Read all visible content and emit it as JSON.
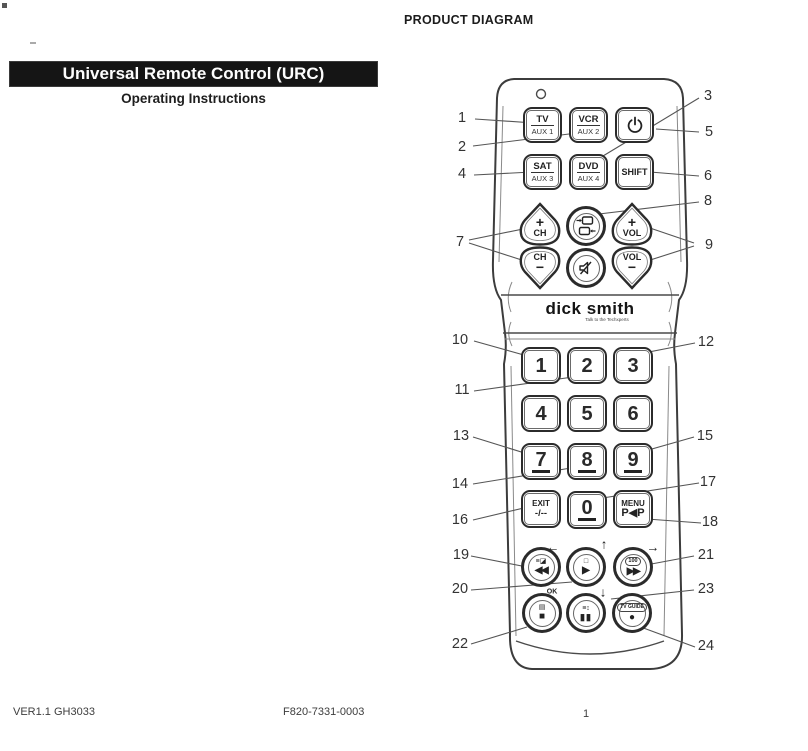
{
  "page": {
    "heading": "PRODUCT DIAGRAM",
    "banner_title": "Universal Remote Control (URC)",
    "subtitle": "Operating Instructions",
    "footer": {
      "version": "VER1.1 GH3033",
      "code": "F820-7331-0003",
      "page_number": "1"
    }
  },
  "remote": {
    "brand": "dick smith",
    "brand_tagline": "Talk to the Techxperts",
    "device_keys": {
      "tv": {
        "top": "TV",
        "bottom": "AUX 1"
      },
      "vcr": {
        "top": "VCR",
        "bottom": "AUX 2"
      },
      "sat": {
        "top": "SAT",
        "bottom": "AUX 3"
      },
      "dvd": {
        "top": "DVD",
        "bottom": "AUX 4"
      }
    },
    "shift_label": "SHIFT",
    "channel": {
      "up_sign": "+",
      "label": "CH",
      "down_sign": "−"
    },
    "volume": {
      "up_sign": "+",
      "label": "VOL",
      "down_sign": "−"
    },
    "digits": [
      "1",
      "2",
      "3",
      "4",
      "5",
      "6",
      "7",
      "8",
      "9",
      "0"
    ],
    "exit": {
      "top": "EXIT",
      "bottom": "-/--"
    },
    "menu": {
      "top": "MENU",
      "bottom": "P◀P"
    },
    "transport": {
      "recall_icon": "≡◪",
      "rewind_icon": "◀◀",
      "play_shape_icon": "□",
      "play_icon": "▶",
      "ff_label": "100",
      "ff_icon": "▶▶",
      "display_icon": "▤",
      "stop_icon": "■",
      "pause_top_icon": "≡↕",
      "pause_icon": "▮▮",
      "tv_guide_label": "TV GUIDE",
      "record_icon": "●",
      "ok_label": "OK",
      "arrow_left": "←",
      "arrow_up": "↑",
      "arrow_right": "→",
      "arrow_down": "↓"
    },
    "icons": [
      "power-icon",
      "tv-av-icon",
      "mute-icon",
      "led-indicator"
    ]
  },
  "callouts": [
    "1",
    "2",
    "3",
    "4",
    "5",
    "6",
    "7",
    "8",
    "9",
    "10",
    "11",
    "12",
    "13",
    "14",
    "15",
    "16",
    "17",
    "18",
    "19",
    "20",
    "21",
    "22",
    "23",
    "24"
  ],
  "colors": {
    "ink": "#222222",
    "banner_bg": "#151515",
    "paper": "#ffffff"
  }
}
